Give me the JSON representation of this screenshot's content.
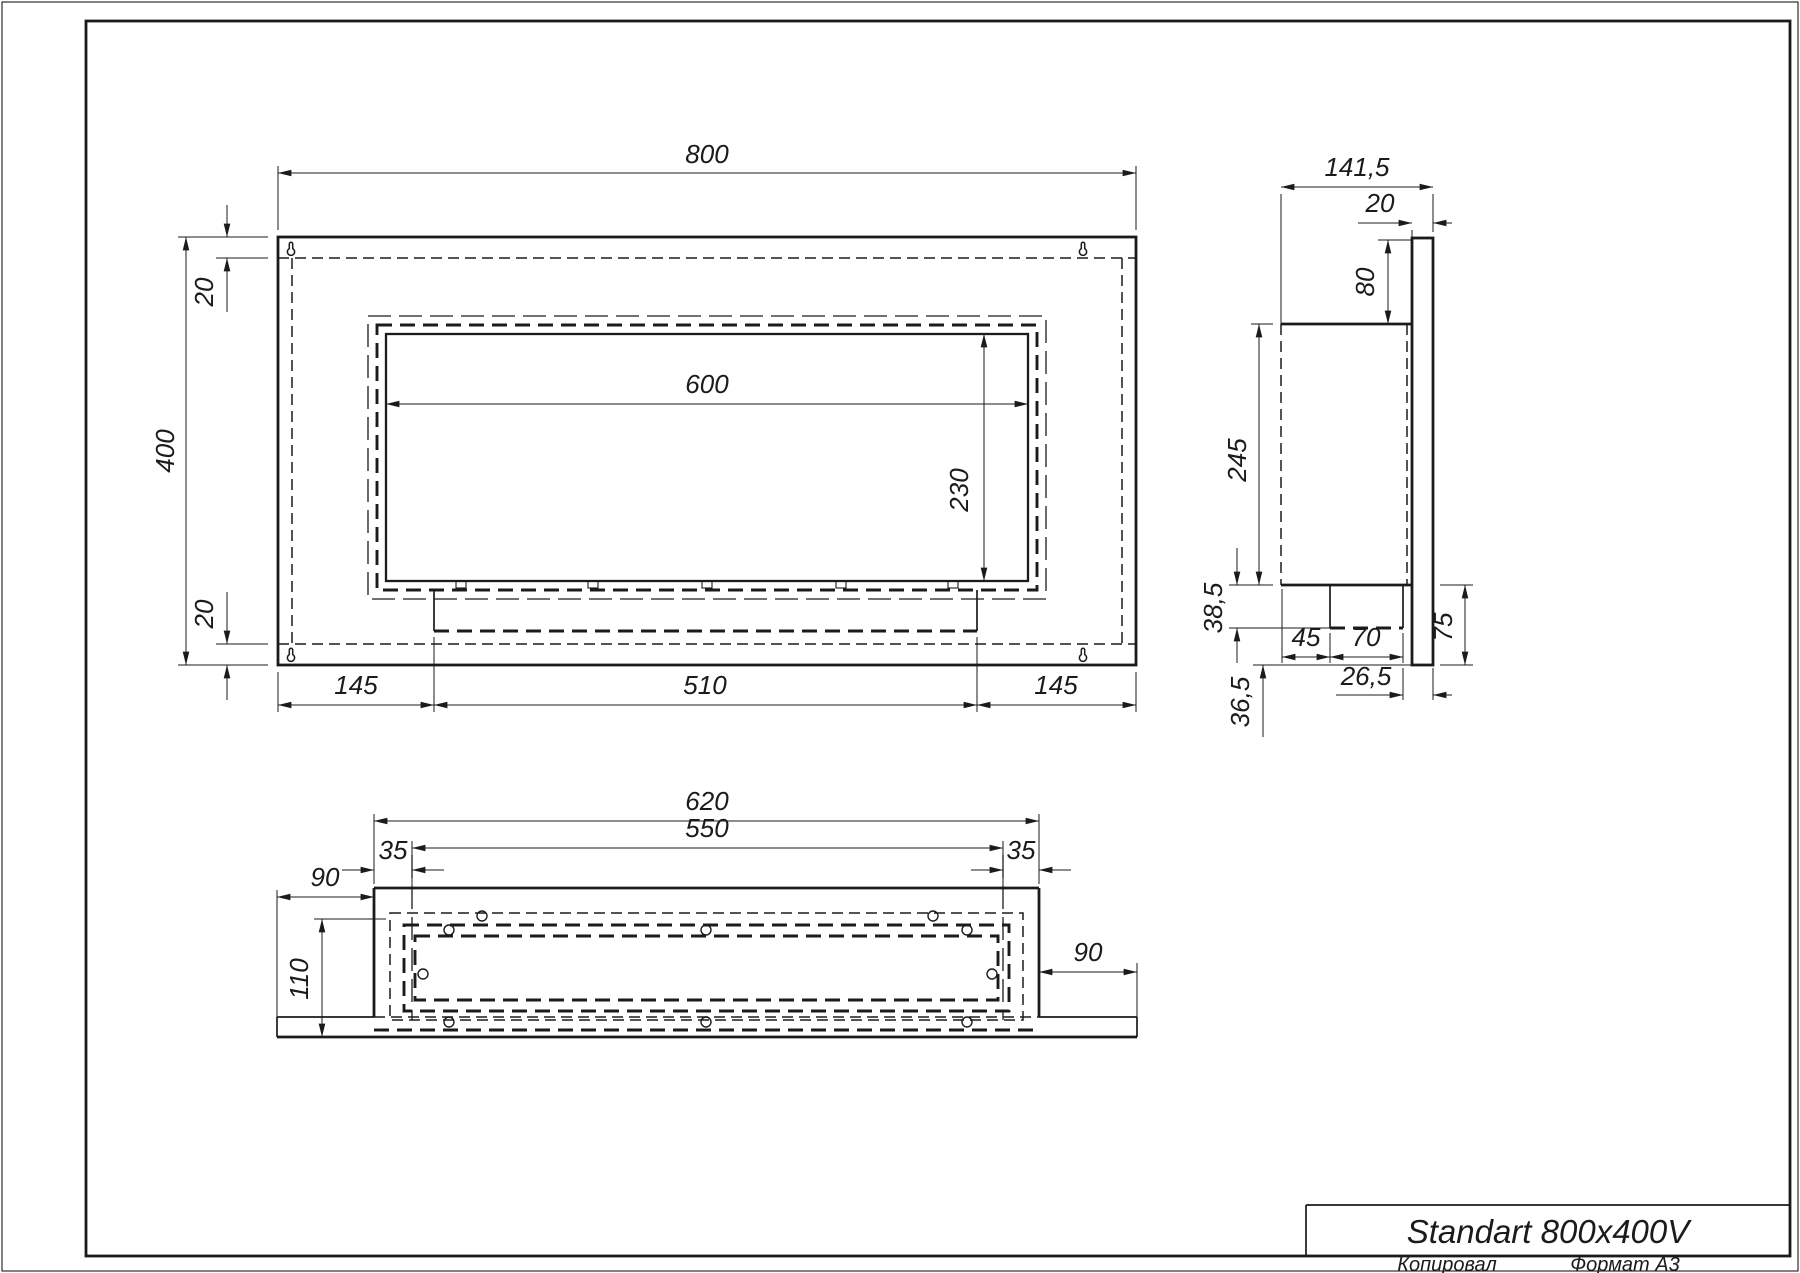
{
  "drawing": {
    "title": "Standart 800x400V",
    "footer": {
      "copied_by": "Копировал",
      "format": "Формат A3"
    },
    "front_view": {
      "width": "800",
      "height": "400",
      "top_wall": "20",
      "bottom_wall": "20",
      "opening_width": "600",
      "opening_height": "230",
      "left_offset": "145",
      "tray_width": "510",
      "right_offset": "145"
    },
    "side_view": {
      "depth": "141,5",
      "back_panel_thickness": "20",
      "top_drop": "80",
      "body_height": "245",
      "tray_height": "38,5",
      "bottom_drop": "36,5",
      "front_gap": "45",
      "tray_depth": "70",
      "panel_tail": "75",
      "back_gap": "26,5"
    },
    "bottom_view": {
      "body_width": "620",
      "opening_width": "550",
      "left_inset": "35",
      "right_inset": "35",
      "left_flange": "90",
      "right_flange": "90",
      "depth": "110"
    },
    "colors": {
      "ink": "#1b1b1b",
      "paper": "#ffffff"
    }
  }
}
